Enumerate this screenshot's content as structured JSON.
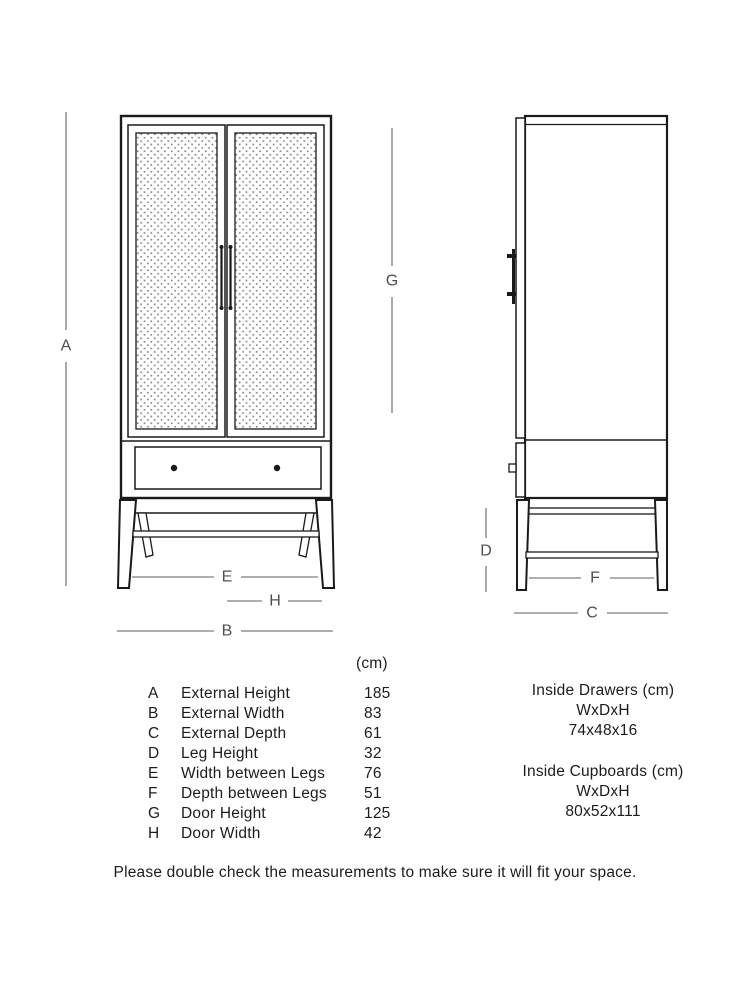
{
  "diagram": {
    "dimension_labels": {
      "a": "A",
      "b": "B",
      "c": "C",
      "d": "D",
      "e": "E",
      "f": "F",
      "g": "G",
      "h": "H"
    }
  },
  "dimensions_table": {
    "unit_header": "(cm)",
    "rows": [
      {
        "letter": "A",
        "label": "External Height",
        "value": "185"
      },
      {
        "letter": "B",
        "label": "External Width",
        "value": "83"
      },
      {
        "letter": "C",
        "label": "External Depth",
        "value": "61"
      },
      {
        "letter": "D",
        "label": "Leg Height",
        "value": "32"
      },
      {
        "letter": "E",
        "label": "Width between Legs",
        "value": "76"
      },
      {
        "letter": "F",
        "label": "Depth between Legs",
        "value": "51"
      },
      {
        "letter": "G",
        "label": "Door Height",
        "value": "125"
      },
      {
        "letter": "H",
        "label": "Door Width",
        "value": "42"
      }
    ]
  },
  "inside_dimensions": {
    "drawers": {
      "title": "Inside Drawers (cm)",
      "axes": "WxDxH",
      "value": "74x48x16"
    },
    "cupboards": {
      "title": "Inside Cupboards (cm)",
      "axes": "WxDxH",
      "value": "80x52x111"
    }
  },
  "footer": {
    "note": "Please double check the measurements to make sure it will fit your space."
  },
  "colors": {
    "background": "#ffffff",
    "furniture_line": "#1a1a1a",
    "dimension_line": "#7d7d7d",
    "dimension_label": "#4f4f4f",
    "body_text": "#1c1c1c",
    "cane_dot": "#8c8c8c"
  }
}
